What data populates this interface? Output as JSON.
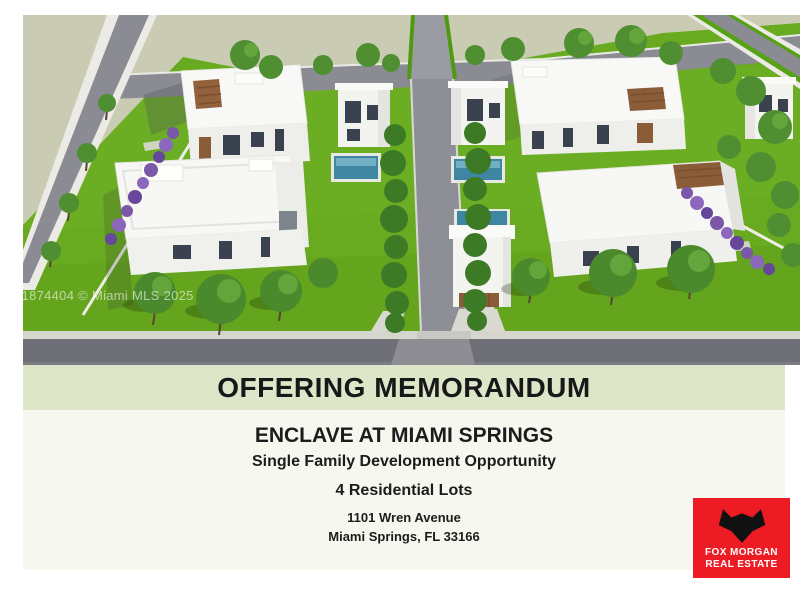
{
  "page": {
    "type": "offering-memorandum-cover",
    "background": "#ffffff"
  },
  "hero": {
    "watermark": "A11874404 © Miami MLS 2025",
    "scene": "aerial-3d-rendering-of-4-modern-single-family-homes",
    "colors": {
      "grass": "#69ab20",
      "ground": "#c9ccb2",
      "road": "#8a8b93",
      "house_white": "#f7f7f5",
      "wood_accent": "#8a5c38",
      "pool": "#3f86a2",
      "flower_hedge": "#7a57a8"
    }
  },
  "banner": {
    "label": "OFFERING MEMORANDUM",
    "background": "#dde6c8",
    "text_color": "#181818"
  },
  "details": {
    "property_name": "ENCLAVE AT MIAMI SPRINGS",
    "offering_type": "Single Family Development Opportunity",
    "lot_count": "4 Residential Lots",
    "address_line1": "1101 Wren Avenue",
    "address_line2": "Miami Springs, FL 33166",
    "background": "#f6f7ef"
  },
  "logo": {
    "name_line1": "FOX MORGAN",
    "name_line2": "REAL ESTATE",
    "icon": "fox-head-icon",
    "background": "#ed1c24"
  }
}
